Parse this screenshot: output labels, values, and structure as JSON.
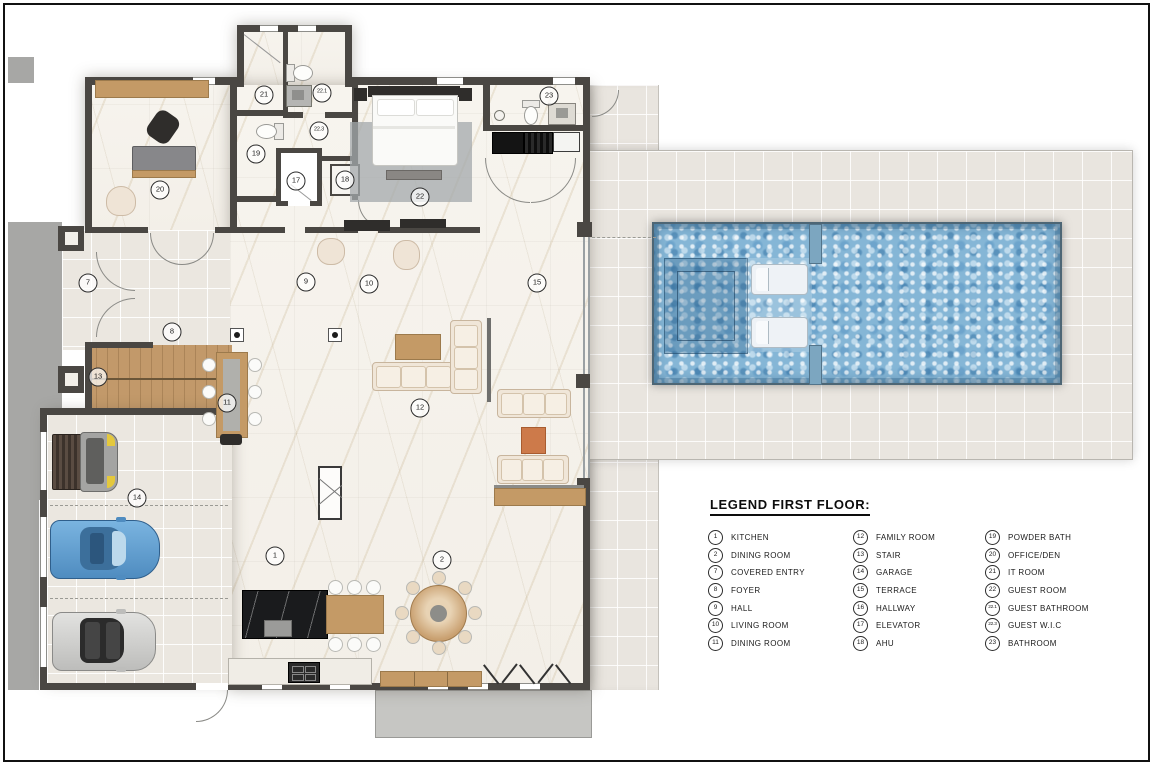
{
  "legend": {
    "title": "LEGEND FIRST  FLOOR:",
    "columns": [
      {
        "items": [
          {
            "num": "1",
            "label": "KITCHEN"
          },
          {
            "num": "2",
            "label": "DINING ROOM"
          },
          {
            "num": "7",
            "label": "COVERED ENTRY"
          },
          {
            "num": "8",
            "label": "FOYER"
          },
          {
            "num": "9",
            "label": "HALL"
          },
          {
            "num": "10",
            "label": "LIVING ROOM"
          },
          {
            "num": "11",
            "label": "DINING ROOM"
          }
        ]
      },
      {
        "items": [
          {
            "num": "12",
            "label": "FAMILY ROOM"
          },
          {
            "num": "13",
            "label": "STAIR"
          },
          {
            "num": "14",
            "label": "GARAGE"
          },
          {
            "num": "15",
            "label": "TERRACE"
          },
          {
            "num": "16",
            "label": "HALLWAY"
          },
          {
            "num": "17",
            "label": "ELEVATOR"
          },
          {
            "num": "18",
            "label": "AHU"
          }
        ]
      },
      {
        "items": [
          {
            "num": "19",
            "label": "POWDER BATH"
          },
          {
            "num": "20",
            "label": "OFFICE/DEN"
          },
          {
            "num": "21",
            "label": "IT ROOM"
          },
          {
            "num": "22",
            "label": "GUEST ROOM"
          },
          {
            "num": "22.1",
            "label": "GUEST BATHROOM"
          },
          {
            "num": "22.3",
            "label": "GUEST W.I.C"
          },
          {
            "num": "23",
            "label": "BATHROOM"
          }
        ]
      }
    ]
  },
  "floor_plan": {
    "markers": [
      {
        "num": "1",
        "x": 275,
        "y": 556
      },
      {
        "num": "2",
        "x": 442,
        "y": 560
      },
      {
        "num": "7",
        "x": 88,
        "y": 283
      },
      {
        "num": "8",
        "x": 172,
        "y": 332
      },
      {
        "num": "9",
        "x": 306,
        "y": 282
      },
      {
        "num": "10",
        "x": 369,
        "y": 284
      },
      {
        "num": "11",
        "x": 227,
        "y": 403
      },
      {
        "num": "12",
        "x": 420,
        "y": 408
      },
      {
        "num": "13",
        "x": 98,
        "y": 377
      },
      {
        "num": "14",
        "x": 137,
        "y": 498
      },
      {
        "num": "15",
        "x": 537,
        "y": 283
      },
      {
        "num": "17",
        "x": 296,
        "y": 181
      },
      {
        "num": "18",
        "x": 345,
        "y": 180
      },
      {
        "num": "19",
        "x": 256,
        "y": 154
      },
      {
        "num": "20",
        "x": 160,
        "y": 190
      },
      {
        "num": "21",
        "x": 264,
        "y": 95
      },
      {
        "num": "22",
        "x": 420,
        "y": 197
      },
      {
        "num": "22.1",
        "x": 322,
        "y": 93
      },
      {
        "num": "22.3",
        "x": 319,
        "y": 131
      },
      {
        "num": "23",
        "x": 549,
        "y": 96
      }
    ],
    "colors": {
      "wall": "#4a4743",
      "marble_floor": "#f6f3ed",
      "tile_floor": "#ebe7e0",
      "terrace_tile": "#e9e5df",
      "driveway": "#a7a7a5",
      "pool_water": "#85b6d6",
      "pool_rim": "#4d6675",
      "wood": "#c2996a",
      "kitchen_island": "#1a1b1d",
      "sofa_cream": "#f0e6d8",
      "accent_orange": "#cd7a4a",
      "car_blue": "#5f9fd3",
      "car_silver": "#d6d6d4",
      "truck_grey": "#9a9a98",
      "truck_yellow": "#e8c built"
    }
  }
}
